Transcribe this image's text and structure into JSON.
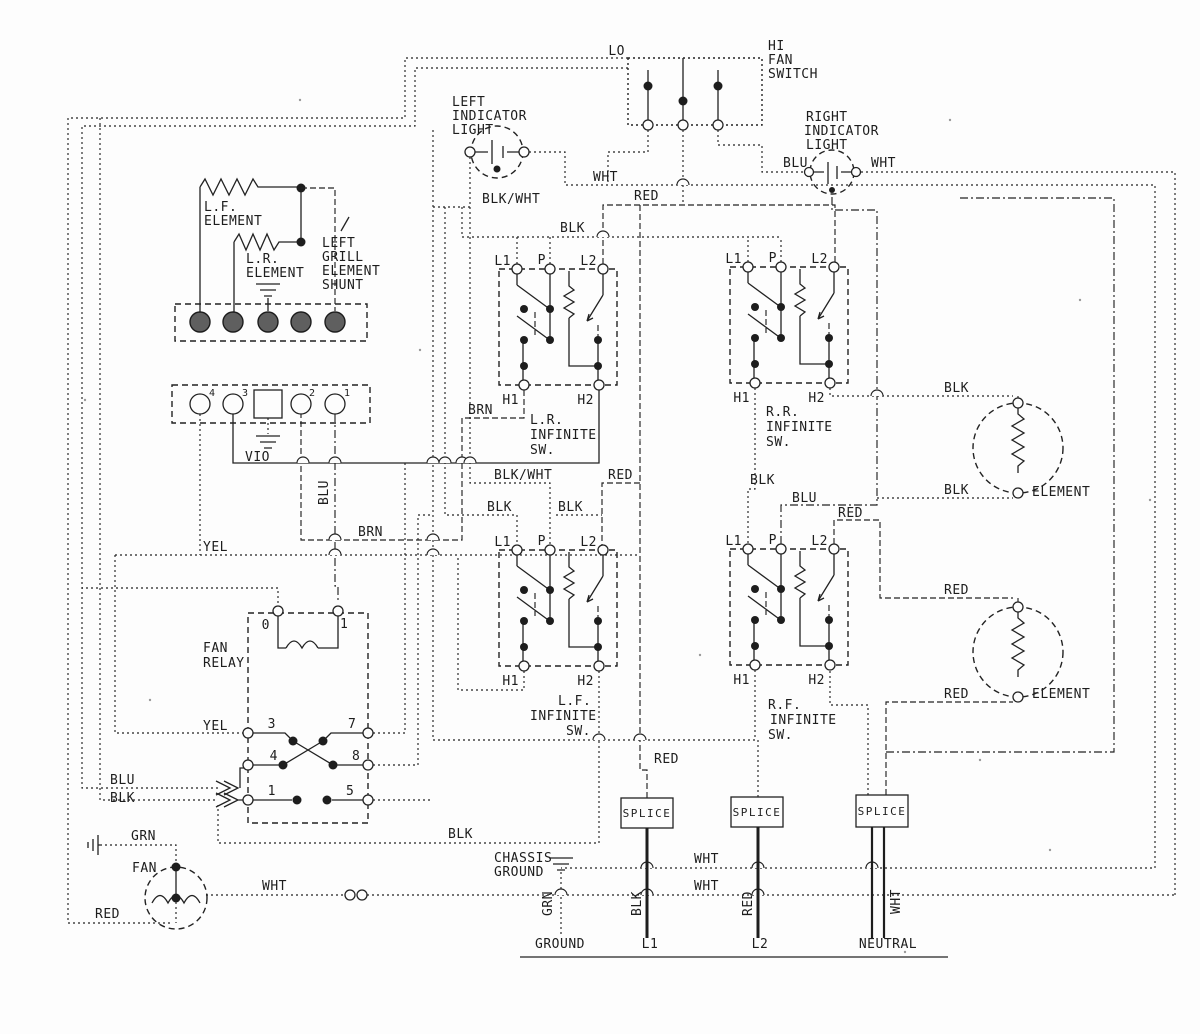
{
  "page": {
    "bg": "#fdfdfd",
    "ink": "#1d1d1d"
  },
  "components": {
    "fan_switch": {
      "lo": "LO",
      "hi": "HI",
      "name": [
        "FAN",
        "SWITCH"
      ]
    },
    "left_indicator_light": {
      "name": [
        "LEFT",
        "INDICATOR",
        "LIGHT"
      ]
    },
    "right_indicator_light": {
      "name": [
        "RIGHT",
        "INDICATOR",
        "LIGHT"
      ]
    },
    "lf_element": {
      "name": [
        "L.F.",
        "ELEMENT"
      ]
    },
    "lr_element": {
      "name": [
        "L.R.",
        "ELEMENT"
      ]
    },
    "left_grill_shunt": {
      "name": [
        "LEFT",
        "GRILL",
        "ELEMENT",
        "SHUNT"
      ]
    },
    "connector": {
      "pin4": "4",
      "pin3": "3",
      "pin2": "2",
      "pin1": "1"
    },
    "switch_terminals": {
      "l1": "L1",
      "p": "P",
      "l2": "L2",
      "h1": "H1",
      "h2": "H2"
    },
    "lr_infinite_switch": {
      "name": [
        "L.R.",
        "INFINITE",
        "SW."
      ]
    },
    "rr_infinite_switch": {
      "name": [
        "R.R.",
        "INFINITE",
        "SW."
      ]
    },
    "lf_infinite_switch": {
      "name": [
        "L.F.",
        "INFINITE",
        "SW."
      ]
    },
    "rf_infinite_switch": {
      "name": [
        "R.F.",
        "INFINITE",
        "SW."
      ]
    },
    "fan_relay": {
      "name": [
        "FAN",
        "RELAY"
      ],
      "pins": {
        "coil_a": "0",
        "coil_b": "1",
        "p3": "3",
        "p7": "7",
        "p4": "4",
        "p8": "8",
        "p1": "1",
        "p5": "5"
      }
    },
    "fan": {
      "name": "FAN"
    },
    "splice_label": "SPLICE",
    "chassis_ground": {
      "name": [
        "CHASSIS",
        "GROUND"
      ]
    },
    "element_upper": "ELEMENT",
    "element_lower": "ELEMENT",
    "supply": {
      "ground": "GROUND",
      "l1": "L1",
      "l2": "L2",
      "neutral": "NEUTRAL"
    }
  },
  "wire_colors": {
    "blk": "BLK",
    "wht": "WHT",
    "red": "RED",
    "blu": "BLU",
    "brn": "BRN",
    "vio": "VIO",
    "yel": "YEL",
    "grn": "GRN",
    "blk_wht": "BLK/WHT"
  }
}
